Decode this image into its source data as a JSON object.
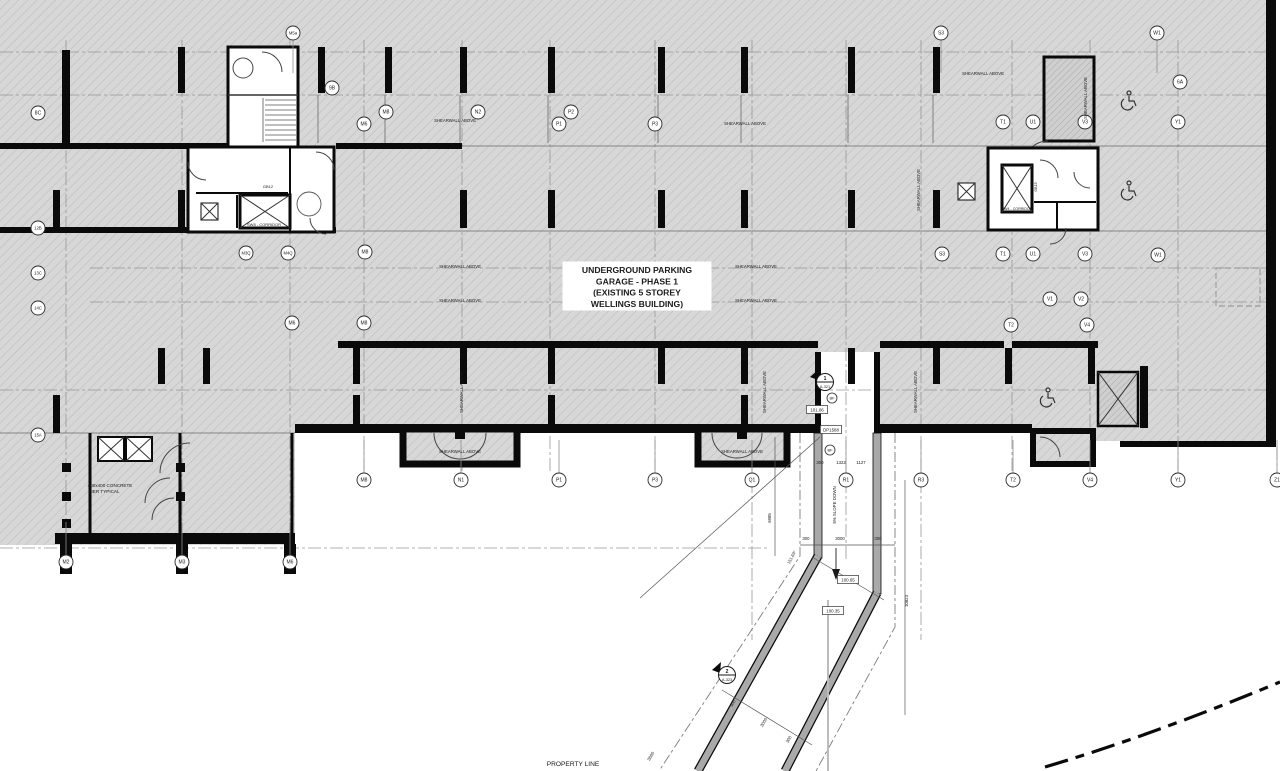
{
  "plan": {
    "title_lines": [
      "UNDERGROUND PARKING",
      "GARAGE - PHASE 1",
      "(EXISTING 5 STOREY",
      "WELLINGS BUILDING)"
    ],
    "property_line_label": "PROPERTY LINE",
    "slope_label": "5% SLOPE DOWN",
    "shearwall_label": "SHEARWALL ABOVE",
    "pier_note_lines": [
      "400x400 CONCRETE",
      "PIER TYPICAL"
    ],
    "corridor_left_label": "SW8 - CORRIDOR",
    "corridor_right_label": "SW4 - CORRIDOR",
    "room_label_left": "GB12",
    "room_label_right": "GB15",
    "bf_label": "BF",
    "angle_label": "151.69°"
  },
  "grid_bubbles": [
    {
      "label": "M5a",
      "x": 293,
      "y": 33,
      "leader": "down"
    },
    {
      "label": "S3",
      "x": 941,
      "y": 33,
      "leader": "down"
    },
    {
      "label": "W1",
      "x": 1157,
      "y": 33,
      "leader": "down"
    },
    {
      "label": "9B",
      "x": 332,
      "y": 88,
      "leader": "none"
    },
    {
      "label": "6A",
      "x": 1180,
      "y": 82,
      "leader": "none"
    },
    {
      "label": "8C",
      "x": 38,
      "y": 113,
      "leader": "none"
    },
    {
      "label": "M8",
      "x": 386,
      "y": 112,
      "leader": "none"
    },
    {
      "label": "N2",
      "x": 478,
      "y": 112,
      "leader": "none"
    },
    {
      "label": "P2",
      "x": 571,
      "y": 112,
      "leader": "none"
    },
    {
      "label": "M6",
      "x": 364,
      "y": 124,
      "leader": "none"
    },
    {
      "label": "P1",
      "x": 559,
      "y": 124,
      "leader": "none"
    },
    {
      "label": "P3",
      "x": 655,
      "y": 124,
      "leader": "none"
    },
    {
      "label": "T1",
      "x": 1003,
      "y": 122,
      "leader": "none"
    },
    {
      "label": "U1",
      "x": 1033,
      "y": 122,
      "leader": "none"
    },
    {
      "label": "V3",
      "x": 1085,
      "y": 122,
      "leader": "none"
    },
    {
      "label": "Y1",
      "x": 1178,
      "y": 122,
      "leader": "none"
    },
    {
      "label": "12B",
      "x": 38,
      "y": 228,
      "leader": "none"
    },
    {
      "label": "13C",
      "x": 38,
      "y": 273,
      "leader": "none"
    },
    {
      "label": "14C",
      "x": 38,
      "y": 308,
      "leader": "none"
    },
    {
      "label": "15A",
      "x": 38,
      "y": 435,
      "leader": "none"
    },
    {
      "label": "M3Q",
      "x": 246,
      "y": 253,
      "leader": "none"
    },
    {
      "label": "M4Q",
      "x": 288,
      "y": 253,
      "leader": "none"
    },
    {
      "label": "M8",
      "x": 365,
      "y": 252,
      "leader": "none"
    },
    {
      "label": "S3",
      "x": 942,
      "y": 254,
      "leader": "none"
    },
    {
      "label": "T1",
      "x": 1003,
      "y": 254,
      "leader": "none"
    },
    {
      "label": "U1",
      "x": 1033,
      "y": 254,
      "leader": "none"
    },
    {
      "label": "V3",
      "x": 1085,
      "y": 254,
      "leader": "none"
    },
    {
      "label": "W1",
      "x": 1158,
      "y": 255,
      "leader": "none"
    },
    {
      "label": "V1",
      "x": 1050,
      "y": 299,
      "leader": "none"
    },
    {
      "label": "V2",
      "x": 1081,
      "y": 299,
      "leader": "none"
    },
    {
      "label": "M6",
      "x": 292,
      "y": 323,
      "leader": "none"
    },
    {
      "label": "M8",
      "x": 364,
      "y": 323,
      "leader": "none"
    },
    {
      "label": "T2",
      "x": 1011,
      "y": 325,
      "leader": "none"
    },
    {
      "label": "V4",
      "x": 1087,
      "y": 325,
      "leader": "none"
    },
    {
      "label": "M8",
      "x": 364,
      "y": 480,
      "leader": "up"
    },
    {
      "label": "N1",
      "x": 461,
      "y": 480,
      "leader": "up"
    },
    {
      "label": "P1",
      "x": 559,
      "y": 480,
      "leader": "up"
    },
    {
      "label": "P3",
      "x": 655,
      "y": 480,
      "leader": "up"
    },
    {
      "label": "Q1",
      "x": 752,
      "y": 480,
      "leader": "up"
    },
    {
      "label": "R1",
      "x": 846,
      "y": 480,
      "leader": "up"
    },
    {
      "label": "R3",
      "x": 921,
      "y": 480,
      "leader": "up"
    },
    {
      "label": "T2",
      "x": 1013,
      "y": 480,
      "leader": "up"
    },
    {
      "label": "V4",
      "x": 1090,
      "y": 480,
      "leader": "up"
    },
    {
      "label": "Y1",
      "x": 1178,
      "y": 480,
      "leader": "up"
    },
    {
      "label": "Z1",
      "x": 1277,
      "y": 480,
      "leader": "up"
    },
    {
      "label": "M2",
      "x": 66,
      "y": 562,
      "leader": "up"
    },
    {
      "label": "M3",
      "x": 182,
      "y": 562,
      "leader": "up"
    },
    {
      "label": "M6",
      "x": 290,
      "y": 562,
      "leader": "up"
    }
  ],
  "shearwall_instances": [
    {
      "x": 455,
      "y": 122,
      "rot": 0
    },
    {
      "x": 745,
      "y": 125,
      "rot": 0
    },
    {
      "x": 983,
      "y": 75,
      "rot": 0
    },
    {
      "x": 460,
      "y": 268,
      "rot": 0
    },
    {
      "x": 756,
      "y": 268,
      "rot": 0
    },
    {
      "x": 460,
      "y": 302,
      "rot": 0
    },
    {
      "x": 756,
      "y": 302,
      "rot": 0
    },
    {
      "x": 920,
      "y": 190,
      "rot": -90
    },
    {
      "x": 1087,
      "y": 98,
      "rot": -90
    },
    {
      "x": 917,
      "y": 392,
      "rot": -90
    },
    {
      "x": 463,
      "y": 392,
      "rot": -90
    },
    {
      "x": 766,
      "y": 392,
      "rot": -90
    },
    {
      "x": 460,
      "y": 453,
      "rot": 0
    },
    {
      "x": 742,
      "y": 453,
      "rot": 0
    }
  ],
  "dimensions": [
    {
      "text": "6985",
      "x": 771,
      "y": 518,
      "rot": -90
    },
    {
      "text": "10823",
      "x": 908,
      "y": 601,
      "rot": -90
    },
    {
      "text": "300",
      "x": 806,
      "y": 540,
      "rot": 0
    },
    {
      "text": "3000",
      "x": 840,
      "y": 540,
      "rot": 0
    },
    {
      "text": "300",
      "x": 878,
      "y": 540,
      "rot": 0
    },
    {
      "text": "300",
      "x": 820,
      "y": 464,
      "rot": 0
    },
    {
      "text": "1322",
      "x": 841,
      "y": 464,
      "rot": 0
    },
    {
      "text": "1127",
      "x": 861,
      "y": 464,
      "rot": 0
    },
    {
      "text": "300",
      "x": 734,
      "y": 704,
      "rot": -60
    },
    {
      "text": "3000",
      "x": 765,
      "y": 723,
      "rot": -60
    },
    {
      "text": "300",
      "x": 790,
      "y": 740,
      "rot": -60
    },
    {
      "text": "3885",
      "x": 652,
      "y": 757,
      "rot": -60
    }
  ],
  "elevation_markers": [
    {
      "text": "101.06",
      "x": 817,
      "y": 410
    },
    {
      "text": "DP1588",
      "x": 831,
      "y": 430
    },
    {
      "text": "100.65",
      "x": 848,
      "y": 580
    },
    {
      "text": "100.35",
      "x": 833,
      "y": 611
    }
  ],
  "section_markers": [
    {
      "num": "1",
      "sheet": "A-321",
      "x": 825,
      "y": 382
    },
    {
      "num": "2",
      "sheet": "A-323",
      "x": 727,
      "y": 675
    }
  ],
  "bf_markers": [
    {
      "x": 832,
      "y": 398
    },
    {
      "x": 830,
      "y": 450
    }
  ]
}
